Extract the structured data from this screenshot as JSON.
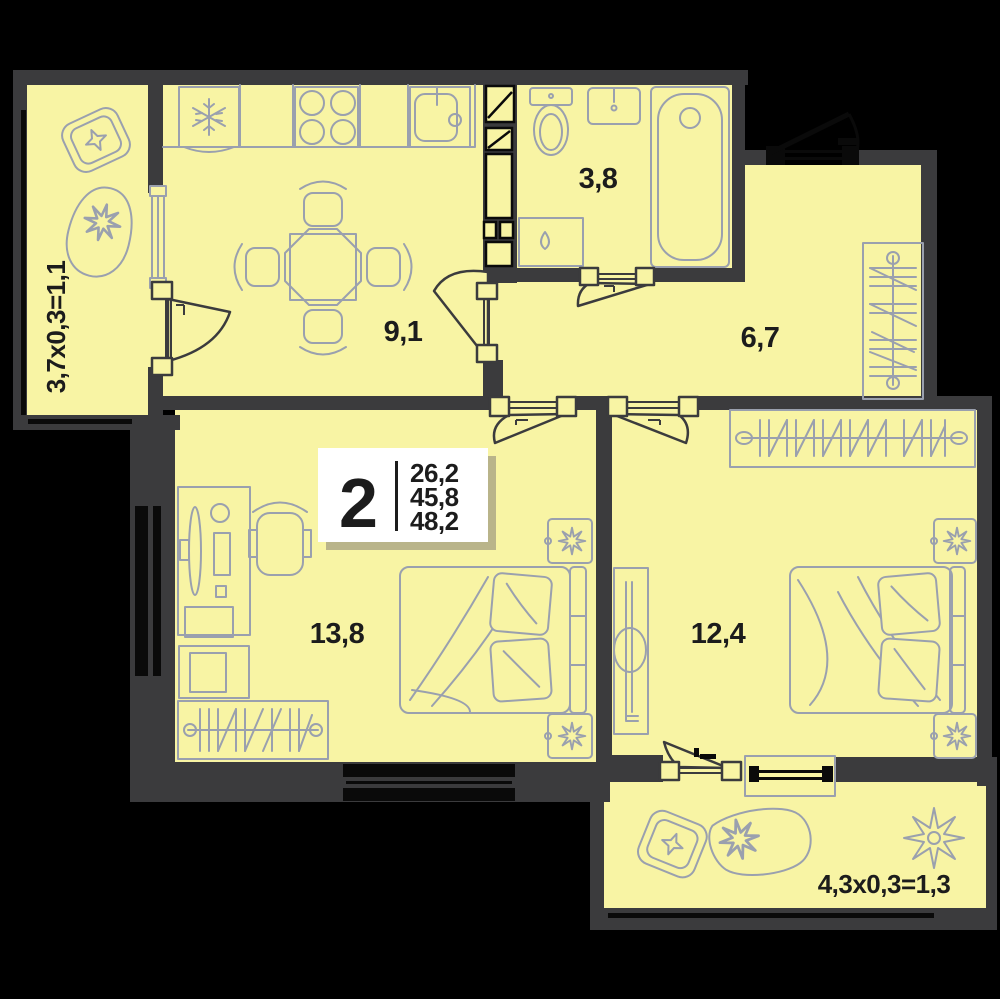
{
  "plan": {
    "type": "apartment-floorplan",
    "badge": {
      "room_count": "2",
      "areas": [
        "26,2",
        "45,8",
        "48,2"
      ]
    },
    "rooms": {
      "balcony_left": {
        "label": "3,7x0,3=1,1"
      },
      "kitchen": {
        "label": "9,1"
      },
      "bathroom": {
        "label": "3,8"
      },
      "hallway": {
        "label": "6,7"
      },
      "bedroom_left": {
        "label": "13,8"
      },
      "bedroom_right": {
        "label": "12,4"
      },
      "balcony_bottom": {
        "label": "4,3x0,3=1,3"
      }
    },
    "colors": {
      "background": "#000000",
      "wall": "#3b3b3d",
      "room_fill": "#f8f4a4",
      "furniture_stroke": "#9aa0ae",
      "black_detail": "#0a0a0a",
      "label_text": "#1c1c1c",
      "badge_bg": "#ffffff",
      "badge_shadow": "#b9b48a"
    }
  }
}
